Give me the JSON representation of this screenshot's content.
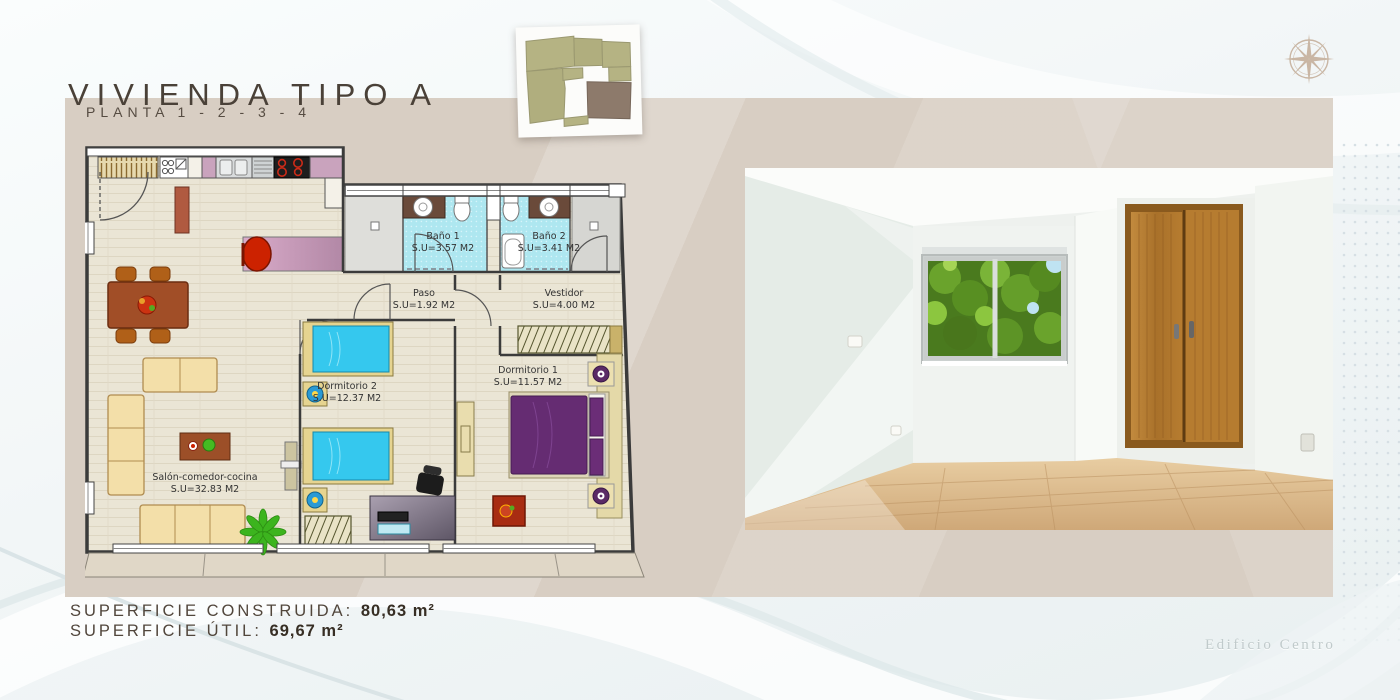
{
  "page": {
    "title": "VIVIENDA TIPO A",
    "subtitle": "PLANTA 1 - 2 - 3 - 4",
    "watermark": "Edificio Centro"
  },
  "summary": {
    "built_label": "SUPERFICIE CONSTRUIDA:",
    "built_value": "80,63 m²",
    "useful_label": "SUPERFICIE ÚTIL:",
    "useful_value": "69,67 m²"
  },
  "floorplan": {
    "rooms": [
      {
        "id": "banyo1",
        "name": "Baño 1",
        "area": "S.U=3.57 M2"
      },
      {
        "id": "banyo2",
        "name": "Baño 2",
        "area": "S.U=3.41 M2"
      },
      {
        "id": "paso",
        "name": "Paso",
        "area": "S.U=1.92 M2"
      },
      {
        "id": "vestidor",
        "name": "Vestidor",
        "area": "S.U=4.00 M2"
      },
      {
        "id": "dormitorio2",
        "name": "Dormitorio 2",
        "area": "S.U=12.37 M2"
      },
      {
        "id": "dormitorio1",
        "name": "Dormitorio 1",
        "area": "S.U=11.57 M2"
      },
      {
        "id": "salon",
        "name": "Salón-comedor-cocina",
        "area": "S.U=32.83 M2"
      }
    ]
  },
  "icons": {
    "compass": "compass-rose-icon",
    "keyplan": "site-key-plan"
  },
  "colors": {
    "panel_beige": "#d8cec3",
    "plan_floor": "#e9e4d4",
    "bath_tile": "#aee7f0",
    "accent_mauve": "#c9a3bd",
    "bed_cyan": "#35c8ee",
    "bed_purple": "#652c72",
    "wood_brown": "#a14e27",
    "keyplan_olive": "#b5b383",
    "keyplan_unit": "#8d7a6b",
    "compass_tan": "#c9b6a4"
  }
}
